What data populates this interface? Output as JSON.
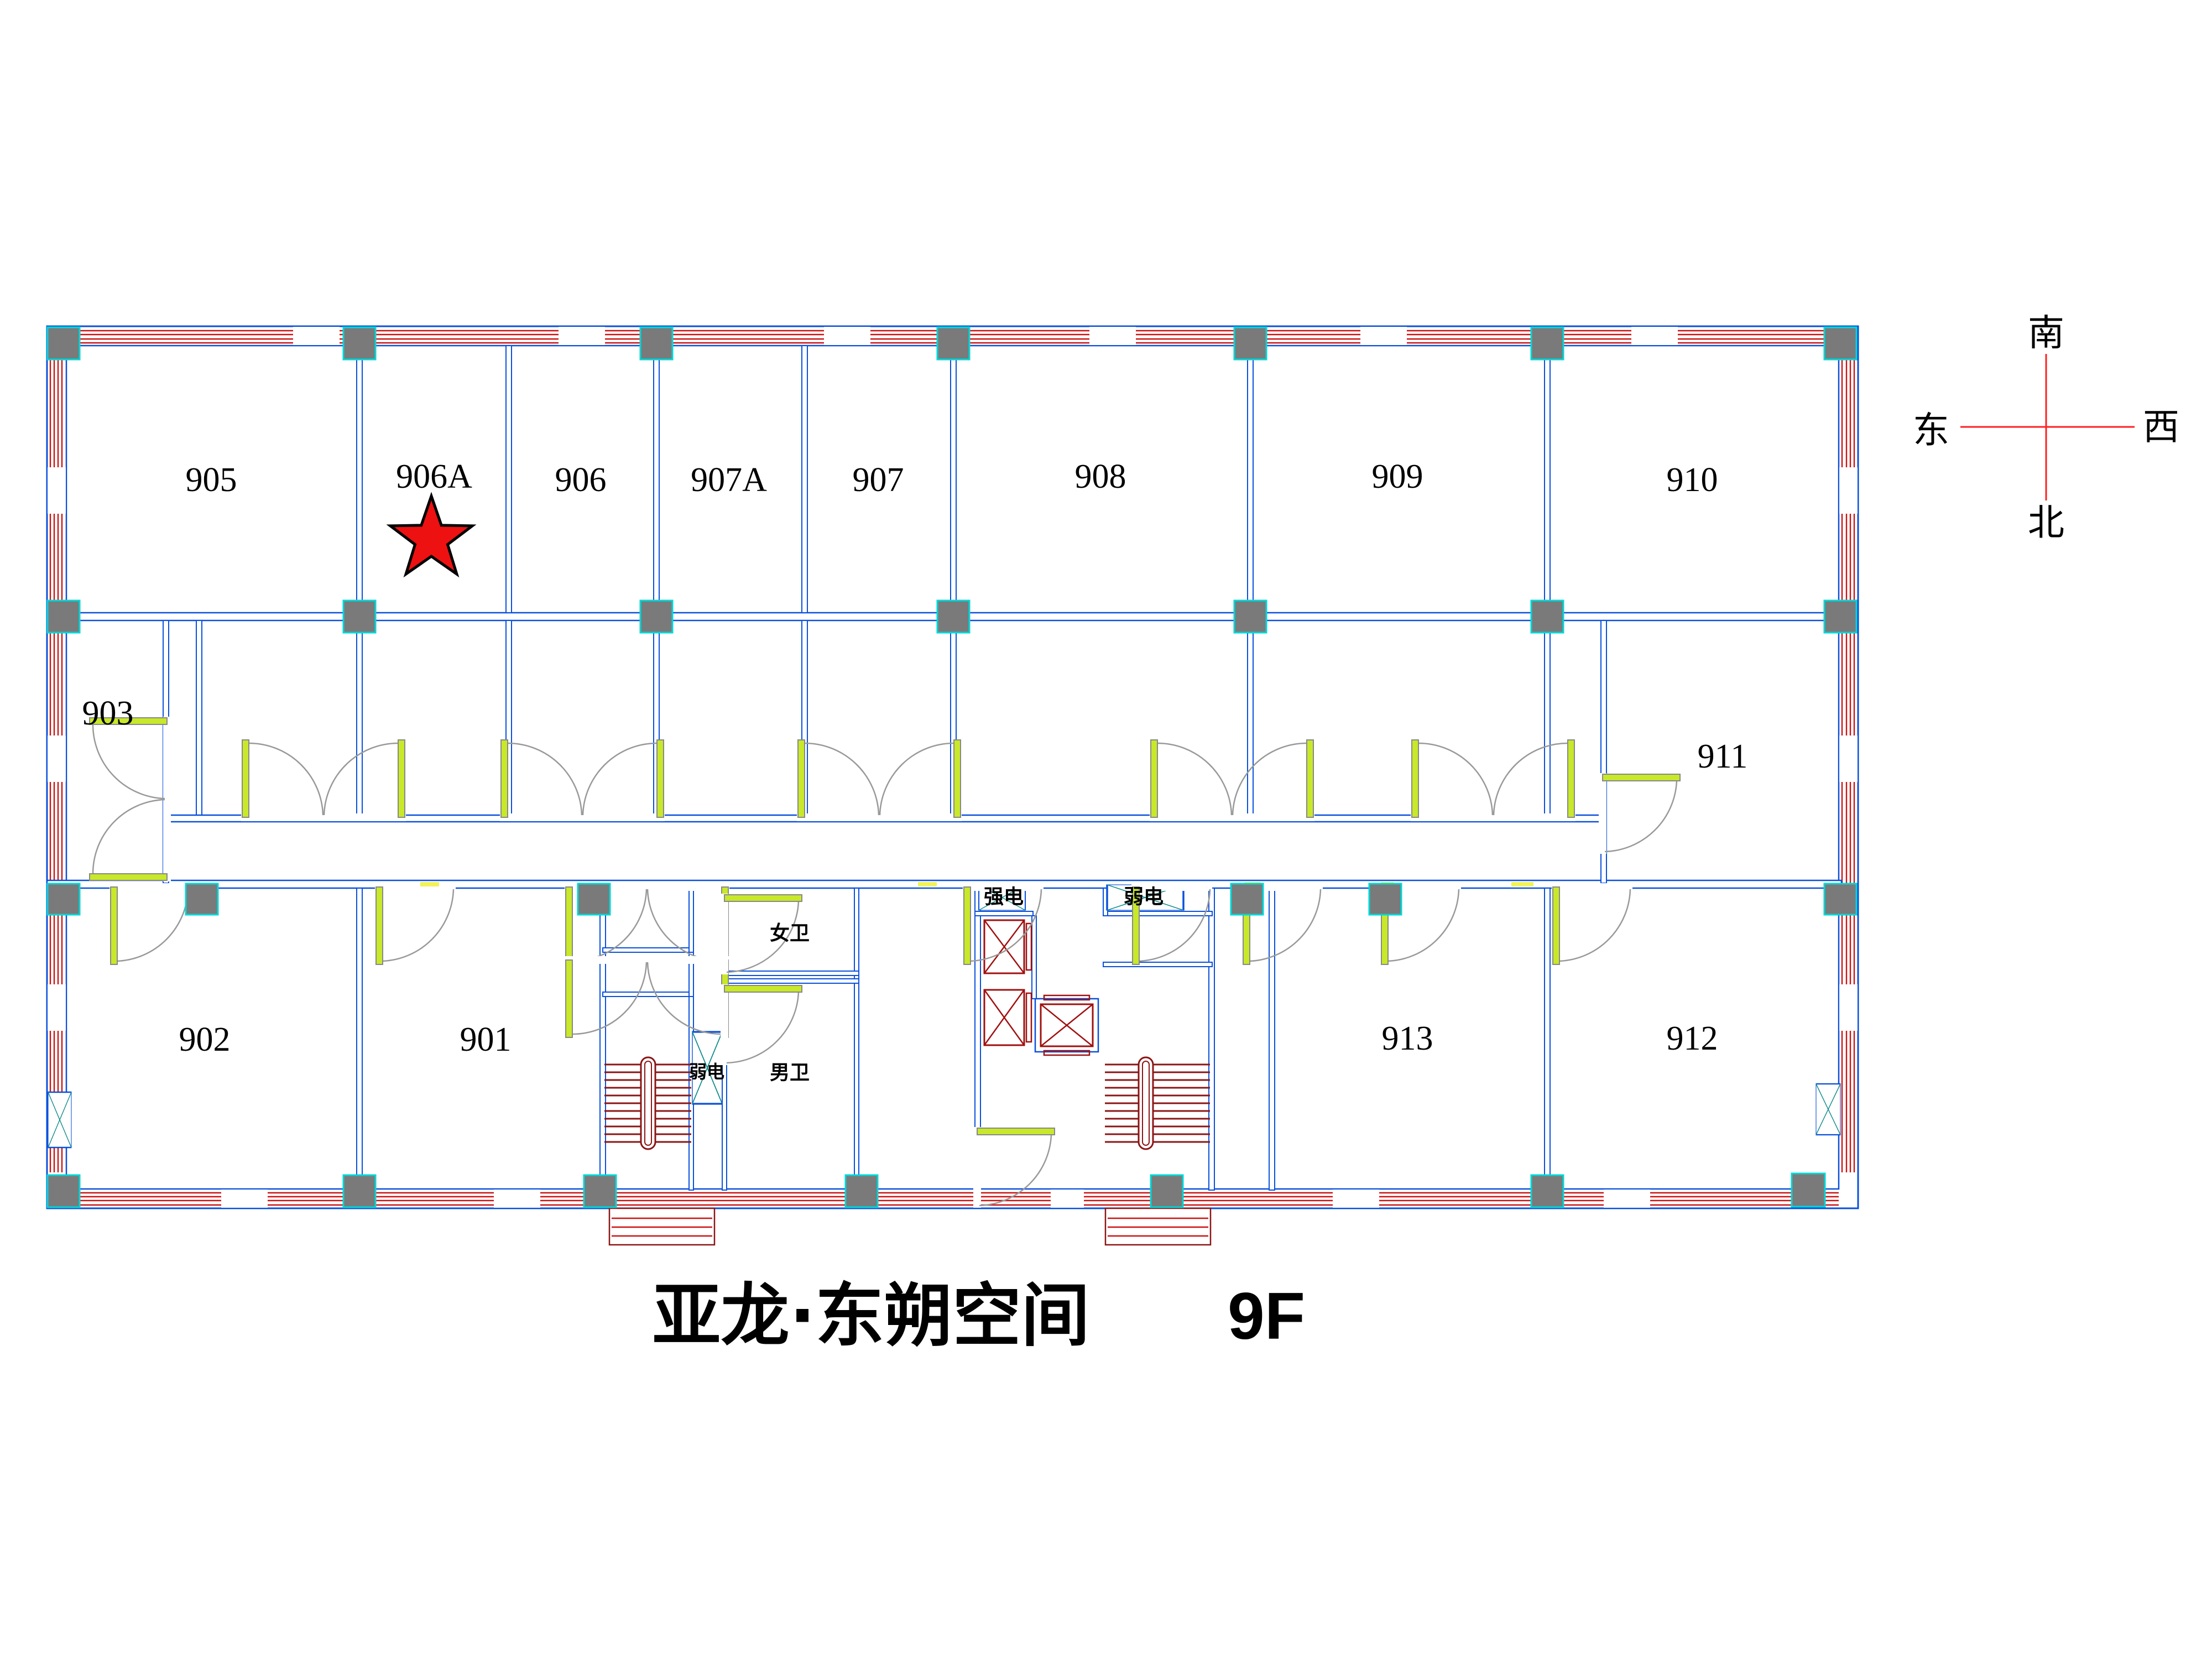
{
  "title": {
    "project": "亚龙·东朔空间",
    "floor": "9F"
  },
  "compass": {
    "south": "南",
    "north": "北",
    "east": "东",
    "west": "西"
  },
  "rooms": [
    {
      "id": "905",
      "label": "905"
    },
    {
      "id": "906A",
      "label": "906A"
    },
    {
      "id": "906",
      "label": "906"
    },
    {
      "id": "907A",
      "label": "907A"
    },
    {
      "id": "907",
      "label": "907"
    },
    {
      "id": "908",
      "label": "908"
    },
    {
      "id": "909",
      "label": "909"
    },
    {
      "id": "910",
      "label": "910"
    },
    {
      "id": "911",
      "label": "911"
    },
    {
      "id": "903",
      "label": "903"
    },
    {
      "id": "902",
      "label": "902"
    },
    {
      "id": "901",
      "label": "901"
    },
    {
      "id": "913",
      "label": "913"
    },
    {
      "id": "912",
      "label": "912"
    }
  ],
  "facilities": {
    "womens_toilet": "女卫",
    "mens_toilet": "男卫",
    "strong_electric": "强电",
    "weak_electric": "弱电",
    "weak_electric_small": "弱电"
  },
  "marker": {
    "type": "star",
    "room": "906A",
    "color": "#ee1111"
  },
  "colors": {
    "wall_blue": "#0a50dc",
    "window_hatch_red": "#cc1111",
    "column_fill": "#7a7a7a",
    "column_stroke": "#00d8d8",
    "stair_red": "#8b1515",
    "elevator_red": "#a01010",
    "shaft_teal": "#0d8a8a",
    "door_leaf": "#c8e82a",
    "door_arc": "#999999",
    "compass_red": "#ff2020"
  }
}
